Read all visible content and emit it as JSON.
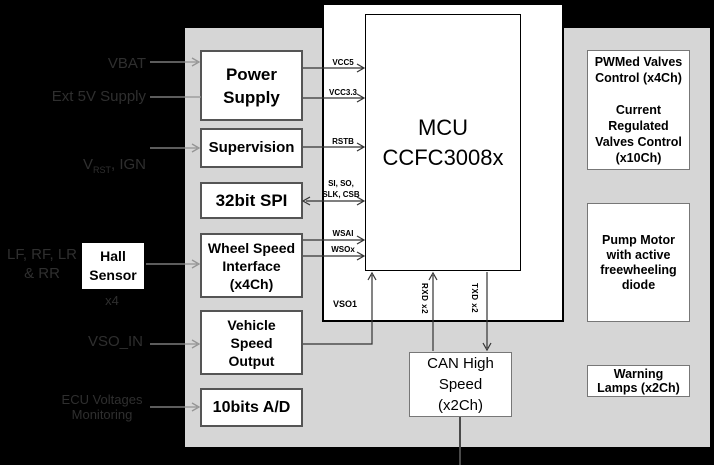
{
  "diagram": {
    "left_inputs": {
      "vbat": "VBAT",
      "ext5v": "Ext 5V Supply",
      "vrst_v": "V",
      "vrst_sub": "RST",
      "vrst_rest": ", IGN",
      "wheels": "LF, RF, LR\n& RR",
      "hall_sensor": "Hall\nSensor",
      "hall_count": "x4",
      "vso_in": "VSO_IN",
      "ecu_monitoring": "ECU Voltages\nMonitoring"
    },
    "interface_column": {
      "power_supply": "Power\nSupply",
      "supervision": "Supervision",
      "spi": "32bit SPI",
      "wheel_speed": "Wheel Speed\nInterface\n(x4Ch)",
      "vehicle_speed": "Vehicle\nSpeed\nOutput",
      "adc": "10bits A/D"
    },
    "mcu": {
      "label": "MCU\nCCFC3008x"
    },
    "signals": {
      "vcc5": "VCC5",
      "vcc33": "VCC3.3",
      "rstb": "RSTB",
      "spi_bus": "SI, SO,\nSLK, CSB",
      "wsai": "WSAI",
      "wsox": "WSOx",
      "vso1": "VSO1",
      "rxd": "RXD x2",
      "txd": "TXD x2"
    },
    "can": {
      "label": "CAN High\nSpeed\n(x2Ch)"
    },
    "output_column": {
      "valves": "PWMed Valves\nControl (x4Ch)\n\nCurrent\nRegulated\nValves Control\n(x10Ch)",
      "pump": "Pump Motor\nwith active\nfreewheeling\ndiode",
      "lamps": "Warning\nLamps (x2Ch)"
    },
    "colors": {
      "canvas": "#000000",
      "panel_gray": "#d6d6d6",
      "box_white": "#ffffff"
    }
  }
}
